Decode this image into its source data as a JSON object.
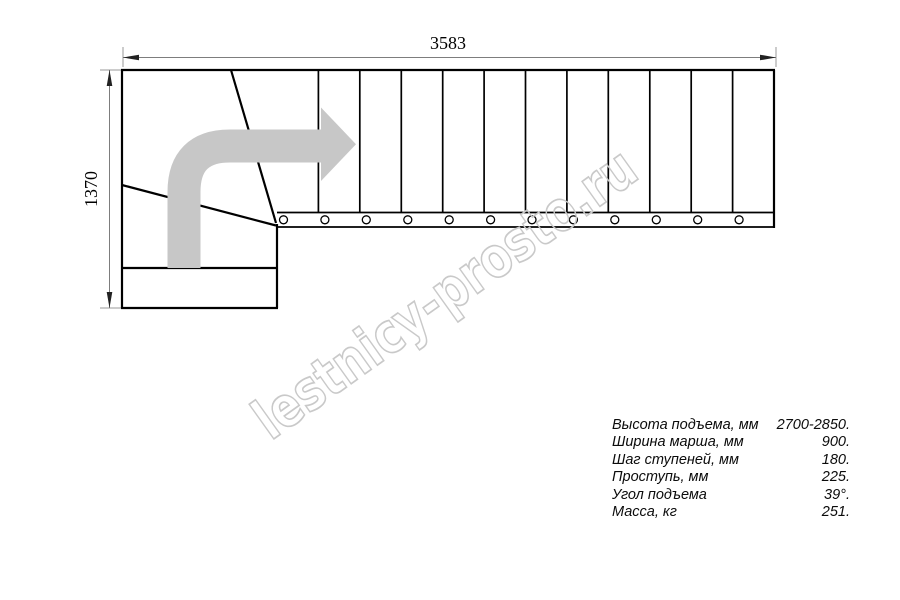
{
  "drawing": {
    "width_label": "3583",
    "height_label": "1370",
    "watermark": "lestnicy-prosto.ru",
    "flight_steps": 12,
    "winder_steps": 2,
    "arrow_color": "#c7c7c7",
    "watermark_color": "#c9c9c9",
    "line_color": "#000000"
  },
  "specs": {
    "rows": [
      {
        "label": "Высота подъема, мм",
        "value": "2700-2850."
      },
      {
        "label": "Ширина марша, мм",
        "value": "900."
      },
      {
        "label": "Шаг ступеней, мм",
        "value": "180."
      },
      {
        "label": "Проступь, мм",
        "value": "225."
      },
      {
        "label": "Угол подъема",
        "value": "39°."
      },
      {
        "label": "Масса, кг",
        "value": "251."
      }
    ]
  }
}
